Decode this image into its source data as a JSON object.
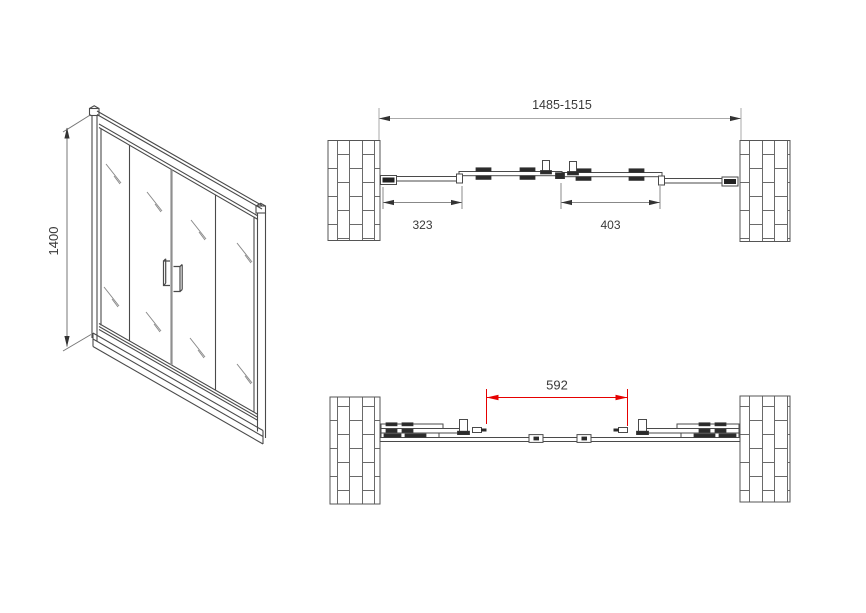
{
  "drawing": {
    "title": "shower-sliding-door-technical-drawing",
    "iso_view": {
      "height_dim": "1400"
    },
    "top_view": {
      "overall_width_dim": "1485-1515",
      "fixed_panel_dim": "323",
      "door_panel_dim": "403"
    },
    "bottom_view": {
      "opening_dim": "592"
    }
  },
  "colors": {
    "line": "#4a4a4a",
    "dim_line": "#999999",
    "arrow": "#333333",
    "text": "#3a3a3a",
    "red": "#e60000"
  }
}
